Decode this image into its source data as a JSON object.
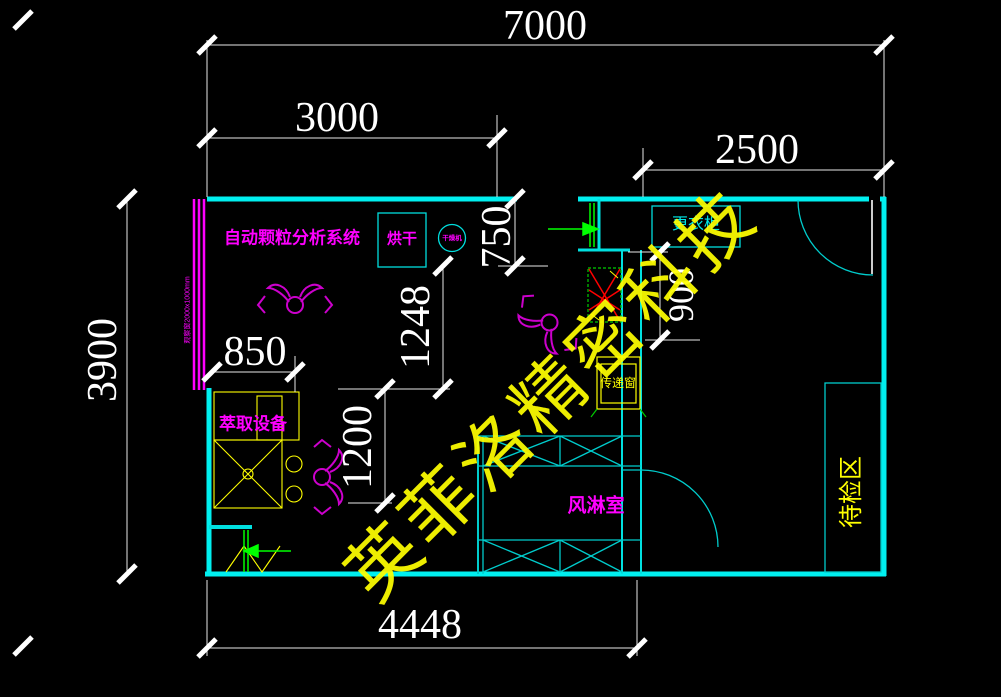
{
  "drawing": {
    "dimensions": {
      "total_width": "7000",
      "left_section_width": "3000",
      "right_section_width": "2500",
      "total_height": "3900",
      "bottom_width": "4448",
      "extraction_width": "850",
      "drying_depth": "750",
      "mid_height_upper": "1248",
      "mid_height_lower": "1200",
      "wardrobe_depth": "900"
    },
    "labels": {
      "particle_system": "自动颗粒分析系统",
      "drying": "烘干",
      "dryer_circle": "干燥机",
      "observation_window": "观察窗2000x1000mm",
      "wardrobe": "更衣柜",
      "transfer_window": "传递窗",
      "air_shower": "风淋室",
      "pending_inspection_area": "待检区",
      "extraction_equipment": "萃取设备"
    },
    "watermark": "英菲洛精密科技",
    "colors": {
      "background": "#000000",
      "wall_cyan": "#00efef",
      "dimension_white": "#ffffff",
      "label_magenta": "#ff00ff",
      "label_yellow": "#ffff00",
      "flow_green": "#00ff00",
      "hatch_red": "#ff0000"
    }
  }
}
